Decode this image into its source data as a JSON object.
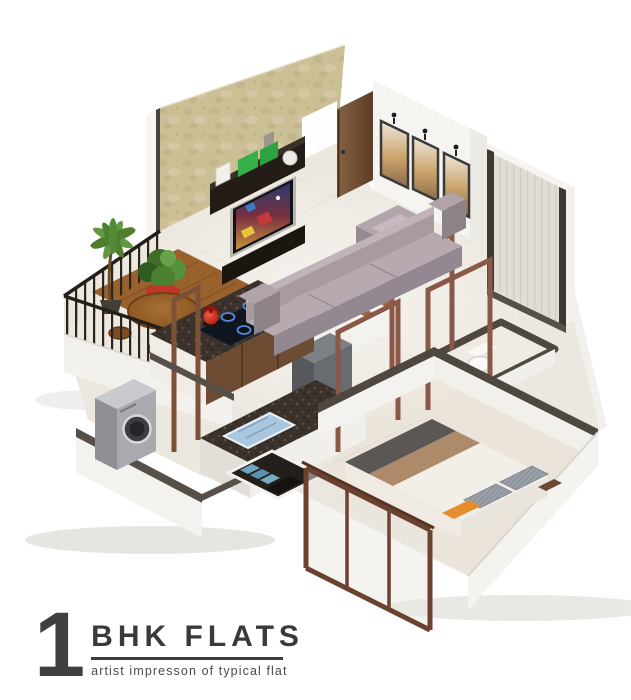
{
  "title_block": {
    "unit_count": "1",
    "title": "BHK FLATS",
    "subtitle": "artist impresson of typical flat"
  },
  "render": {
    "type": "isometric-3d-cutaway-floor-plan",
    "unit_type": "1 BHK apartment",
    "background": "#ffffff",
    "palette": {
      "floor": "#ece7df",
      "accent_wall_tan": "#cbbf96",
      "wall_cap_dark": "#4f4840",
      "outer_wall_white": "#f4f2ee",
      "door_wood": "#7c5a39",
      "open_frame_wood": "#8a5847",
      "sofa_grey": "#a79aa1",
      "rug_brown": "#97876d",
      "granite_counter": "#3a322b",
      "cabinet_wood": "#6d4c33",
      "kettle_red": "#d42b1e",
      "plant_green": "#4e7e2e",
      "planter_red": "#b1271a",
      "balcony_wood": "#99622c",
      "washer_silver": "#a8aab0",
      "bed_runner_grey": "#5b5755",
      "bed_throw_tan": "#ac8a6a",
      "pillow_orange": "#e68e2e",
      "tray_blue": "#aac7dd",
      "sliding_door_frame": "#6b4230",
      "tv_unit_dark": "#241d17"
    },
    "rooms": [
      {
        "name": "Living Room",
        "items": [
          "textured tan accent wall",
          "TV unit with display shelf",
          "TV with colorful screen",
          "green shelf boxes",
          "entrance door (open, wood)",
          "white wall with 3 framed pictures and picture lights",
          "tall window panel with dark trim",
          "grey 3-seater sofa",
          "grey armchair",
          "speckled brown rug",
          "dark grey cube unit"
        ]
      },
      {
        "name": "Balcony",
        "items": [
          "black metal railing",
          "white parapet wall",
          "palm plant",
          "green plant in red planter",
          "round wooden table",
          "wooden stools",
          "wood deck floor"
        ]
      },
      {
        "name": "Kitchen",
        "items": [
          "granite hob counter",
          "4-burner hob",
          "red kettle",
          "wooden drawer cabinets",
          "granite service counter",
          "blue dish tray",
          "open wooden frame posts"
        ]
      },
      {
        "name": "Utility",
        "items": [
          "silver front-loading washing machine"
        ]
      },
      {
        "name": "Passage",
        "items": [
          "white wash basin with wooden ledge",
          "open wooden door frames"
        ]
      },
      {
        "name": "Toilet",
        "items": [
          "western toilet"
        ]
      },
      {
        "name": "Bedroom",
        "items": [
          "double bed with grey runner, tan throw, grey knit pillows and orange cushion",
          "brown-framed sliding glass door",
          "open shelf with folded blue clothes",
          "white cutaway walls with dark caps"
        ]
      }
    ]
  }
}
